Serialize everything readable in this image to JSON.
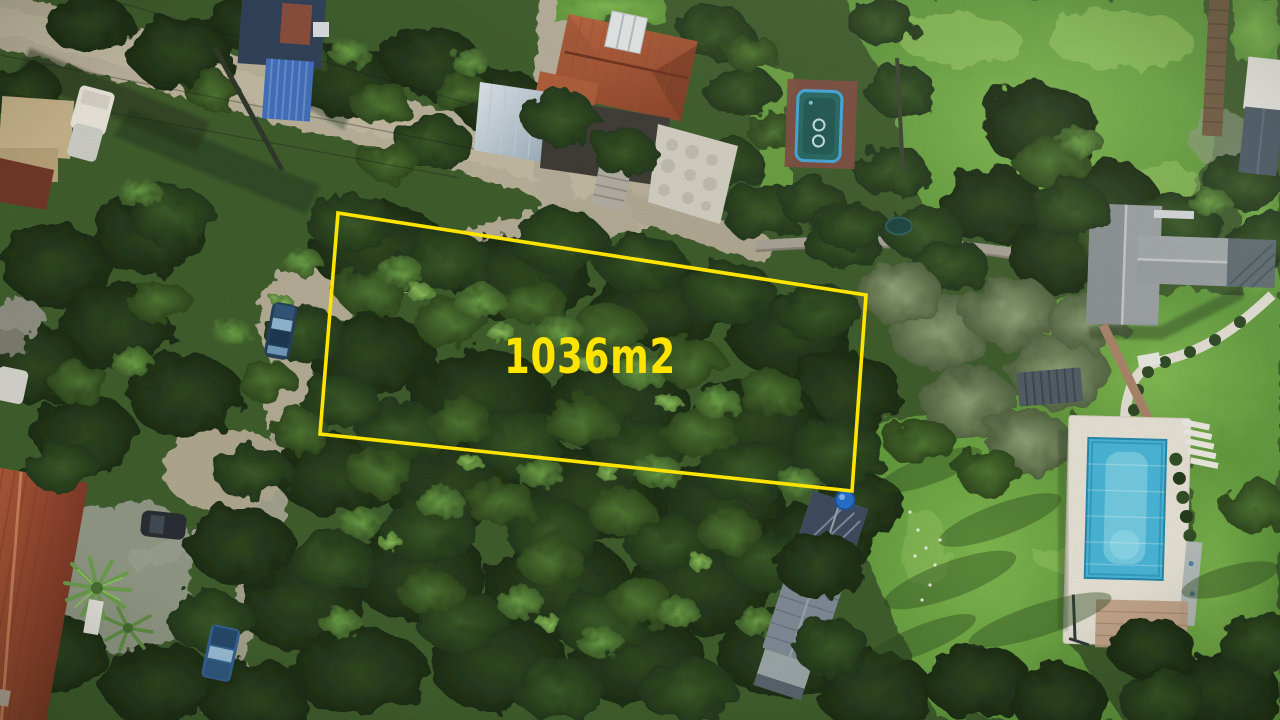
{
  "annotation": {
    "area_label": "1036m2",
    "outline_points": "338,213 866,295 852,491 320,434",
    "outline_color": "#ffe400",
    "label_color": "#ffe400"
  },
  "scene": {
    "description": "Aerial drone photo of a wooded residential block; a tree-covered 1036 m2 parcel is outlined in yellow",
    "features": [
      "dense tree canopy over parcel",
      "dirt road curving around parcel from top-left to bottom-left",
      "red tile roof house top-center",
      "blue-bordered pool top-center-right",
      "large gray-roof house right side with curved white garden wall",
      "rectangular swimming pool with white deck bottom-right",
      "long metal-roof house bottom-center",
      "red tile roof house with palm trees bottom-left",
      "parked cars on road and driveways",
      "bright lawns top-right and bottom-right"
    ]
  }
}
